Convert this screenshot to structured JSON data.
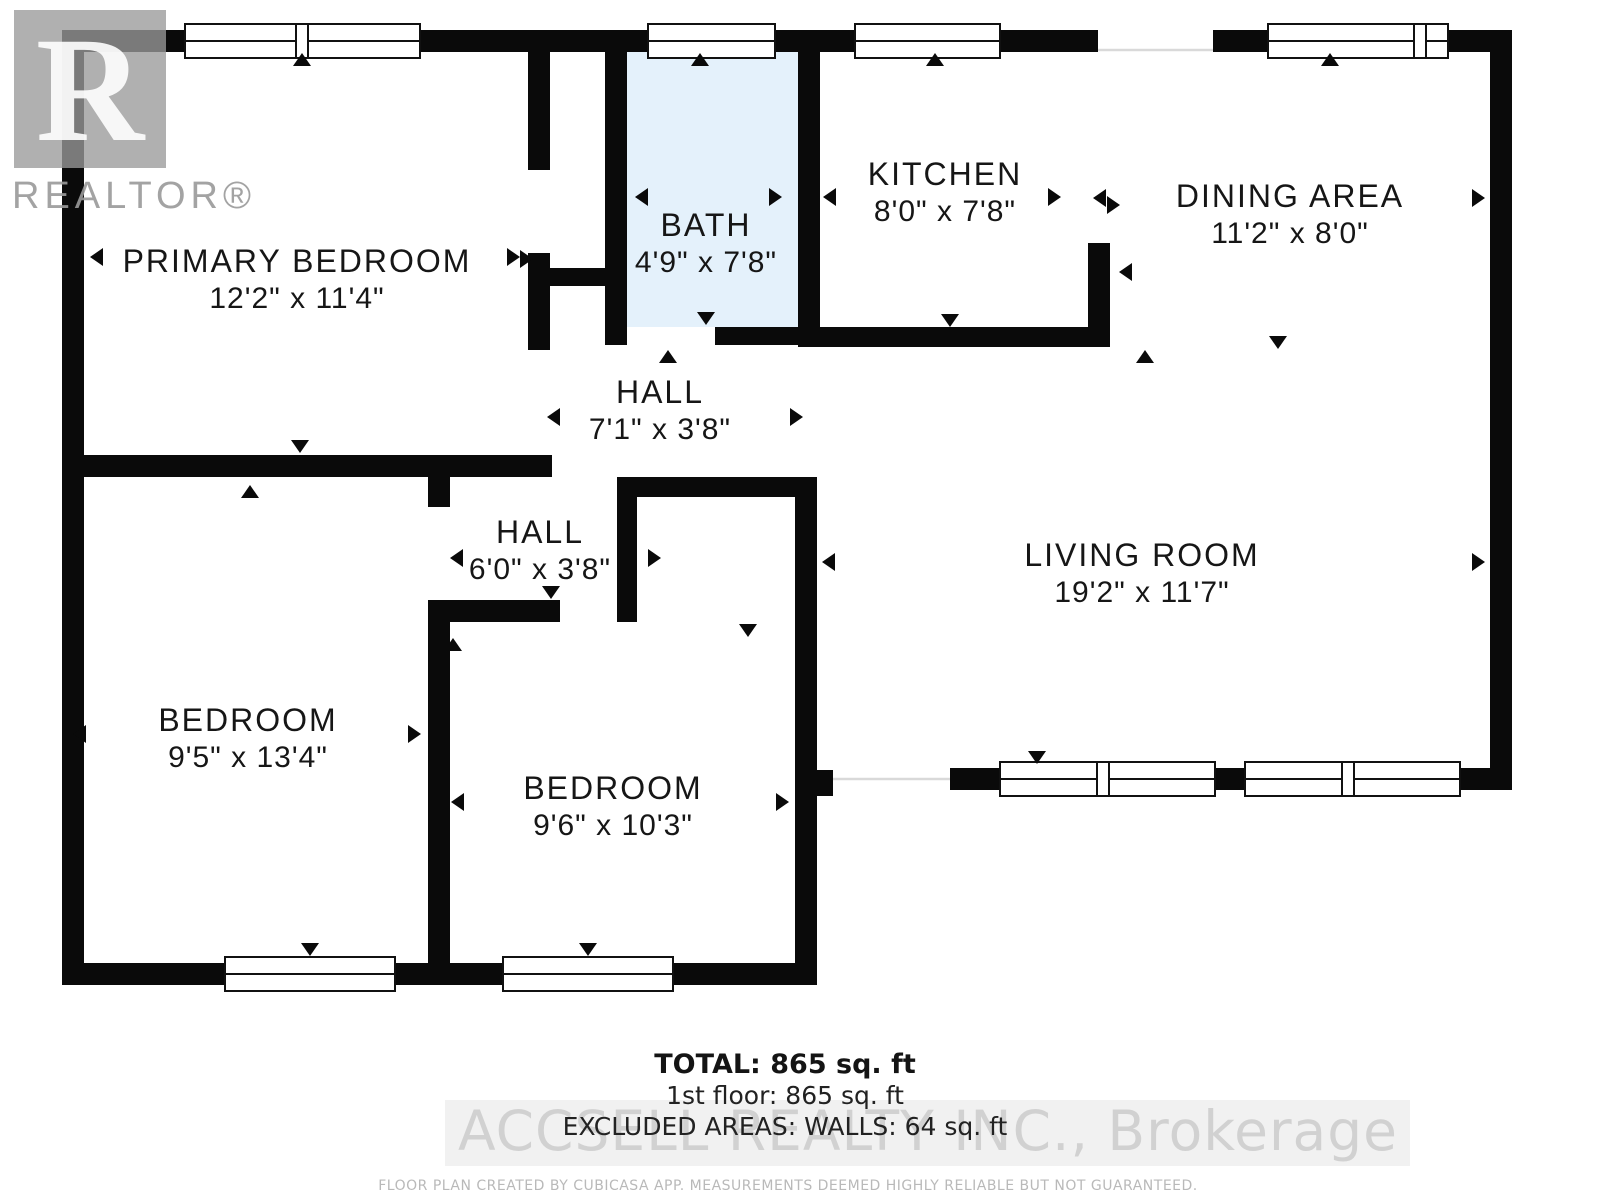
{
  "branding": {
    "logo_letter": "R",
    "logo_word": "REALTOR®"
  },
  "rooms": [
    {
      "name": "PRIMARY BEDROOM",
      "dims": "12'2\" x 11'4\""
    },
    {
      "name": "BATH",
      "dims": "4'9\" x 7'8\""
    },
    {
      "name": "KITCHEN",
      "dims": "8'0\" x 7'8\""
    },
    {
      "name": "DINING AREA",
      "dims": "11'2\" x 8'0\""
    },
    {
      "name": "HALL",
      "dims": "7'1\" x 3'8\""
    },
    {
      "name": "HALL",
      "dims": "6'0\" x 3'8\""
    },
    {
      "name": "LIVING ROOM",
      "dims": "19'2\" x 11'7\""
    },
    {
      "name": "BEDROOM",
      "dims": "9'5\" x 13'4\""
    },
    {
      "name": "BEDROOM",
      "dims": "9'6\" x 10'3\""
    }
  ],
  "summary": {
    "total": "TOTAL: 865 sq. ft",
    "first_floor": "1st floor: 865 sq. ft",
    "excluded": "EXCLUDED AREAS: WALLS: 64 sq. ft"
  },
  "watermark": {
    "brokerage": "ACCSELL REALTY INC., Brokerage"
  },
  "footer": {
    "disclaimer": "FLOOR PLAN CREATED BY CUBICASA APP. MEASUREMENTS DEEMED HIGHLY RELIABLE BUT NOT GUARANTEED."
  },
  "colors": {
    "wall": "#0a0a0a",
    "bath_floor": "#e4f1fb",
    "watermark_gray": "#cfcfcf",
    "watermark_band": "#e3e3e3",
    "logo_gray": "#9a9a9a",
    "opening_line": "#d9d9d9"
  }
}
